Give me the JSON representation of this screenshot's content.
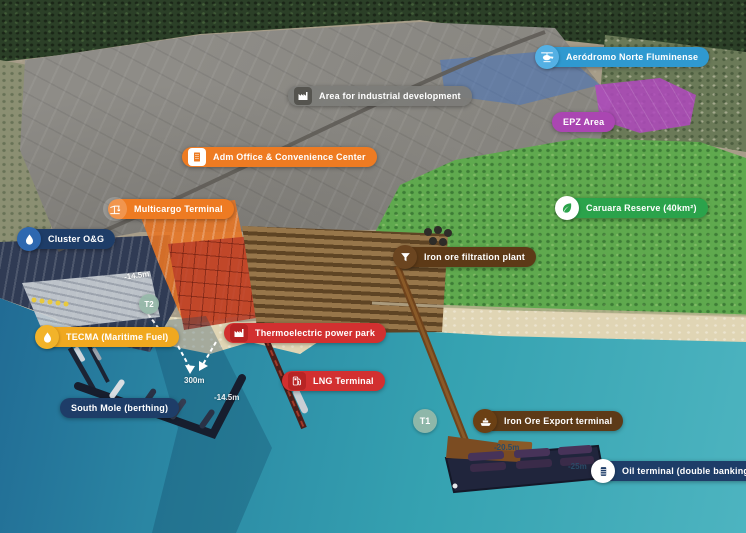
{
  "map": {
    "region": "Port industrial complex aerial master plan",
    "labels": {
      "aerodrome": "Aeródromo Norte Fluminense",
      "industrial_area": "Area for industrial development",
      "epz": "EPZ Area",
      "adm_office": "Adm Office & Convenience Center",
      "multicargo": "Multicargo Terminal",
      "caruara": "Caruara Reserve (40km²)",
      "cluster_og": "Cluster O&G",
      "iron_filtration": "Iron ore filtration plant",
      "tecma": "TECMA (Maritime Fuel)",
      "thermoelectric": "Thermoelectric power park",
      "lng": "LNG Terminal",
      "south_mole": "South Mole (berthing)",
      "iron_ore_export": "Iron Ore Export terminal",
      "oil_terminal": "Oil terminal (double banking)"
    },
    "markers": {
      "t1": "T1",
      "t2": "T2"
    },
    "depths": {
      "inner_channel": "-14.5m",
      "channel_width": "300m",
      "outer_channel": "-14.5m",
      "iron_ore_berth": "-20.5m",
      "oil_berth": "-25m"
    },
    "colors": {
      "blue": "#2f99d0",
      "gray": "#7c7c78",
      "purple": "#aa46b2",
      "orange": "#ee7b22",
      "green": "#2ba34b",
      "navy": "#1e3d68",
      "brown": "#5d3a17",
      "amber": "#f0a81f",
      "red": "#d23030",
      "marker": "#96b9a8"
    }
  }
}
